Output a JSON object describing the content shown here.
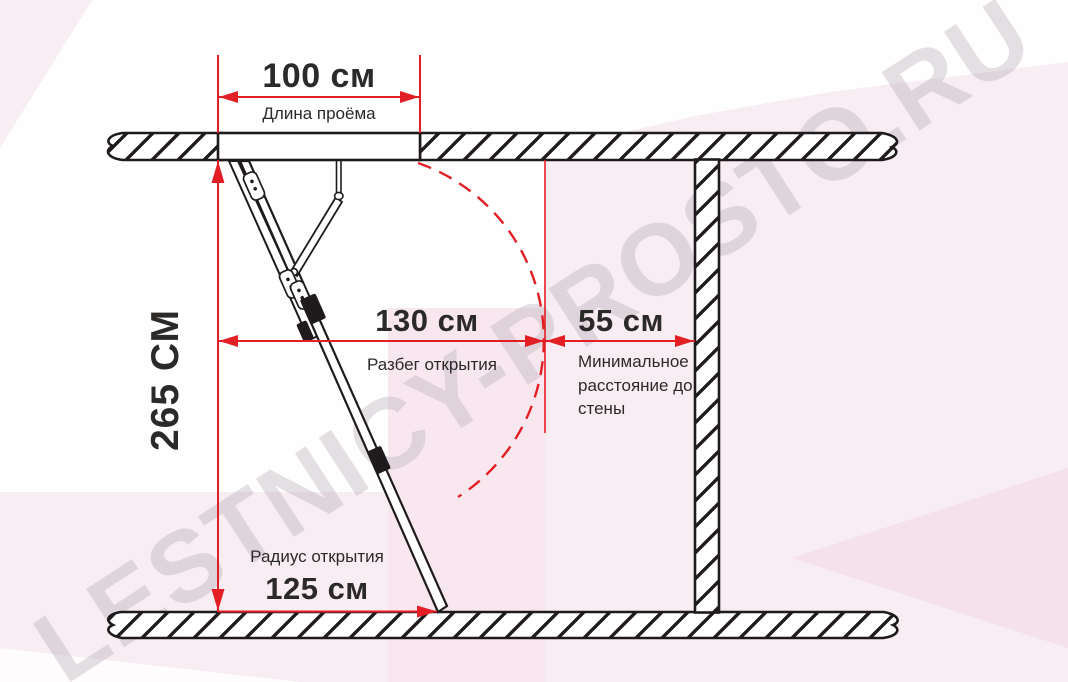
{
  "watermark": "LESTNICY-PROSTO.RU",
  "colors": {
    "dimension_red": "#e31e24",
    "line_black": "#1f1b1c",
    "text_black": "#2b2a29",
    "watermark_gray": "rgba(189,181,189,0.42)",
    "background_pink": "#f7edf3",
    "background_pink_band": "#f8e7ef",
    "background_pink_deep": "#f4e1ec"
  },
  "dimensions": {
    "opening_length": {
      "value": "100 см",
      "label": "Длина проёма"
    },
    "ceiling_height": {
      "value": "265 СМ"
    },
    "opening_run": {
      "value": "130 см",
      "label": "Разбег открытия"
    },
    "wall_distance": {
      "value": "55 см",
      "label": "Минимальное расстояние до стены"
    },
    "opening_radius": {
      "value": "125 см",
      "label": "Радиус открытия"
    }
  }
}
